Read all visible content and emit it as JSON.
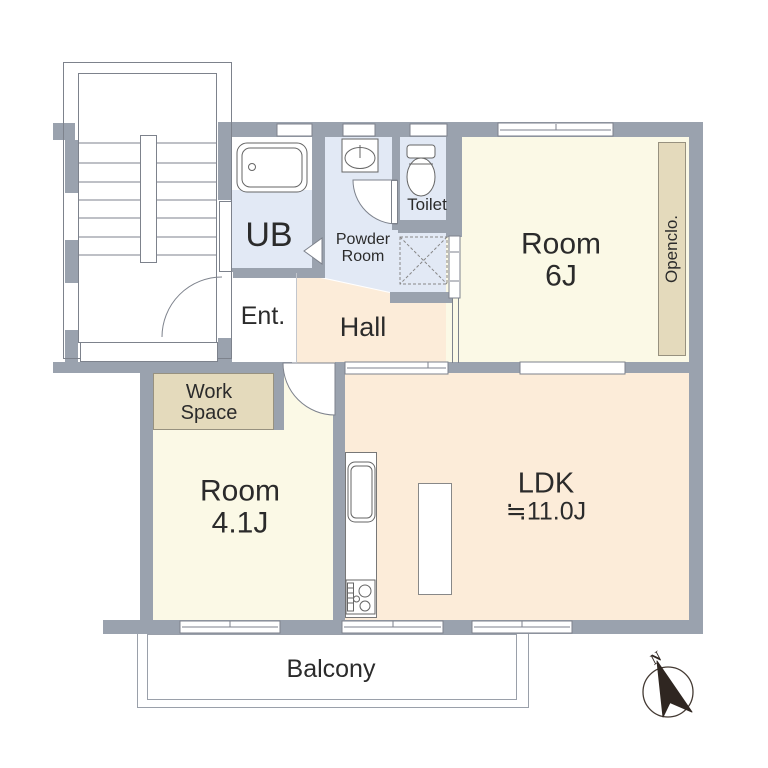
{
  "title": "apartment-floor-plan",
  "colors": {
    "wall": "#9aa2ae",
    "wet": "#e2e9f5",
    "room": "#fbf9e6",
    "living": "#fcecd9",
    "closet": "#e4dabc",
    "closetline": "#97917f",
    "line": "#7d828c",
    "text": "#2b2b2b",
    "compass": "#2f2621"
  },
  "rooms": {
    "ub": {
      "label": "UB"
    },
    "powder": {
      "line1": "Powder",
      "line2": "Room"
    },
    "toilet": {
      "label": "Toilet"
    },
    "room6": {
      "line1": "Room",
      "line2": "6J"
    },
    "openclo": {
      "label": "Openclo."
    },
    "ent": {
      "label": "Ent."
    },
    "hall": {
      "label": "Hall"
    },
    "mb": {
      "label": "MB"
    },
    "workspace": {
      "line1": "Work",
      "line2": "Space"
    },
    "room41": {
      "line1": "Room",
      "line2": "4.1J"
    },
    "ldk": {
      "line1": "LDK",
      "line2": "≒11.0J"
    },
    "table_counter": {
      "line1": "Table",
      "line2": "Counter"
    },
    "balcony": {
      "label": "Balcony"
    },
    "compass": {
      "label": "N"
    }
  }
}
